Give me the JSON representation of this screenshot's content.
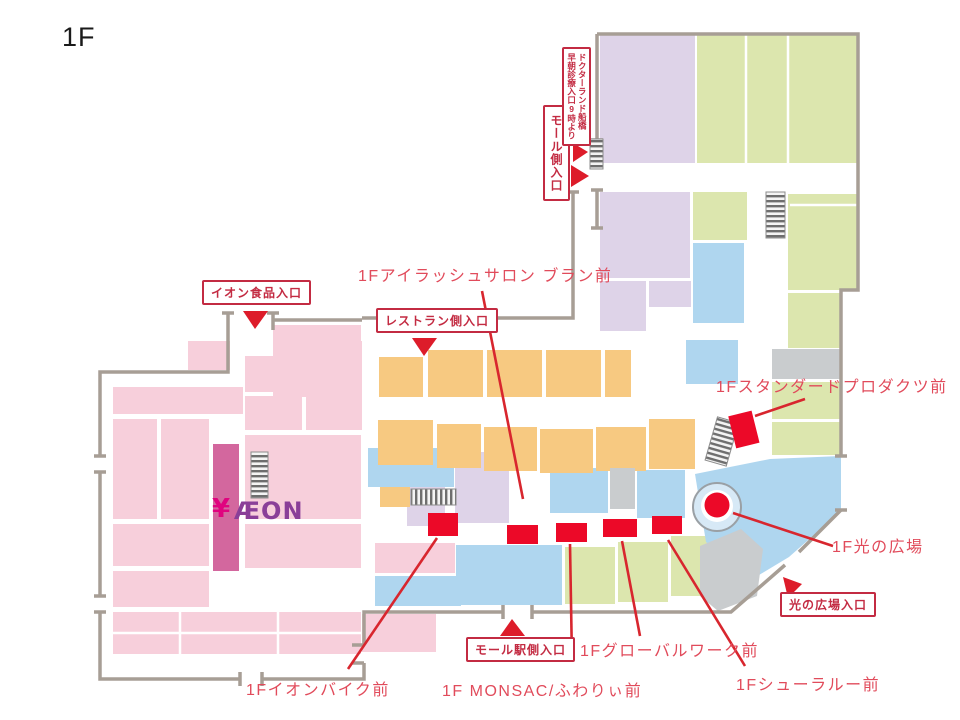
{
  "title": "1F",
  "map": {
    "colors": {
      "pink": "#F7CFDB",
      "pink_dark": "#D3679E",
      "orange": "#F7C981",
      "blue": "#AFD6EF",
      "green": "#DCE6AE",
      "lavender": "#DED3E8",
      "gray_block": "#C9CCCE",
      "wall": "#A79E95",
      "marker_red": "#EC0928",
      "leader_line_red": "#D8262E",
      "label_red": "#E14B5B",
      "entrance_red": "#C32B42",
      "aeon_purple": "#8A3F98",
      "yen_magenta": "#E0037F"
    },
    "logo": {
      "aeon": "ÆON",
      "yen": "¥"
    },
    "entrances": [
      {
        "label": "イオン食品入口"
      },
      {
        "label": "レストラン側入口"
      },
      {
        "label": "モール側入口"
      },
      {
        "line1": "ドクターランド船橋",
        "line2": "早朝診療入口9時より"
      },
      {
        "label": "モール駅側入口"
      },
      {
        "label": "光の広場入口"
      }
    ],
    "locations": [
      {
        "label": "1Fアイラッシュサロン ブラン前"
      },
      {
        "label": "1Fスタンダードプロダクツ前"
      },
      {
        "label": "1F光の広場"
      },
      {
        "label": "1Fシューラルー前"
      },
      {
        "label": "1Fグローバルワーク前"
      },
      {
        "label": "1F MONSAC/ふわりぃ前"
      },
      {
        "label": "1Fイオンバイク前"
      }
    ]
  }
}
